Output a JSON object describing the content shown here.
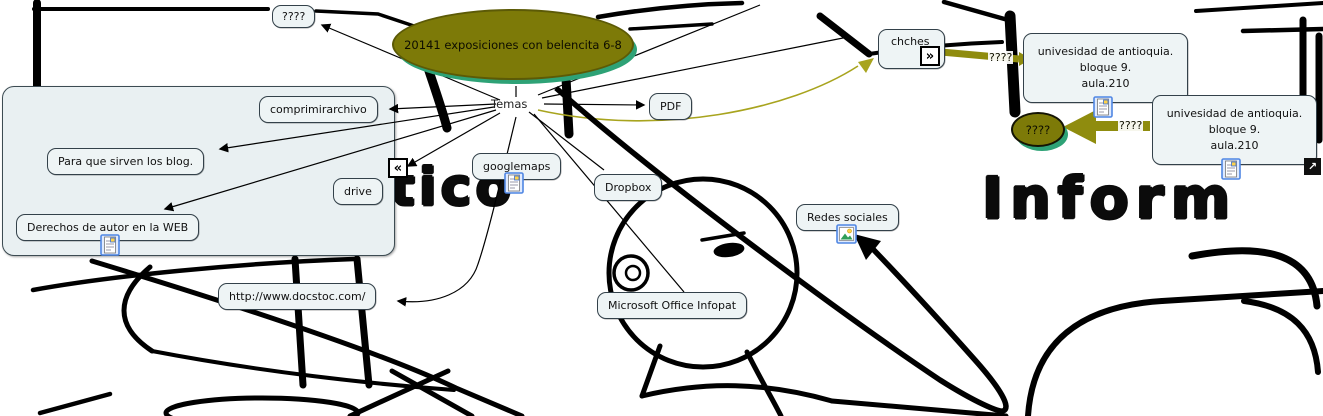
{
  "title_ellipse": {
    "label": "20141 exposiciones con belencita 6-8"
  },
  "hub": {
    "label": "Temas"
  },
  "nodes": {
    "unknown_top": {
      "label": "????"
    },
    "comprimir": {
      "label": "comprimirarchivo"
    },
    "blogs": {
      "label": "Para que sirven los blog."
    },
    "drive": {
      "label": "drive"
    },
    "derechos": {
      "label": "Derechos de autor en la WEB"
    },
    "pdf": {
      "label": "PDF"
    },
    "googlemaps": {
      "label": "googlemaps"
    },
    "dropbox": {
      "label": "Dropbox"
    },
    "redes": {
      "label": "Redes sociales"
    },
    "infopath": {
      "label": "Microsoft Office Infopat"
    },
    "docstoc": {
      "label": "http://www.docstoc.com/"
    },
    "chches": {
      "label": "chches"
    },
    "univ1": {
      "label": "univesidad de antioquia.\nbloque 9.\naula.210"
    },
    "univ2": {
      "label": "univesidad de antioquia.\nbloque 9.\naula.210"
    }
  },
  "small_ellipse": {
    "label": "????"
  },
  "link_labels": {
    "chches_to_univ1": "????",
    "univ2_to_ellipse": "????"
  },
  "background_words": {
    "left": "tico",
    "right": "Inform"
  },
  "icons": {
    "chevron_right": "»",
    "chevron_left": "«",
    "external_arrow": "↗"
  },
  "colors": {
    "ellipse_fill": "#7d7a08",
    "ellipse_shadow_green": "#2ea276",
    "olive_link": "#8f8c0e",
    "olive_curve": "#a8a41e",
    "node_fill": "#eef4f5",
    "panel_fill": "#e9f0f2",
    "line_black": "#000000"
  }
}
